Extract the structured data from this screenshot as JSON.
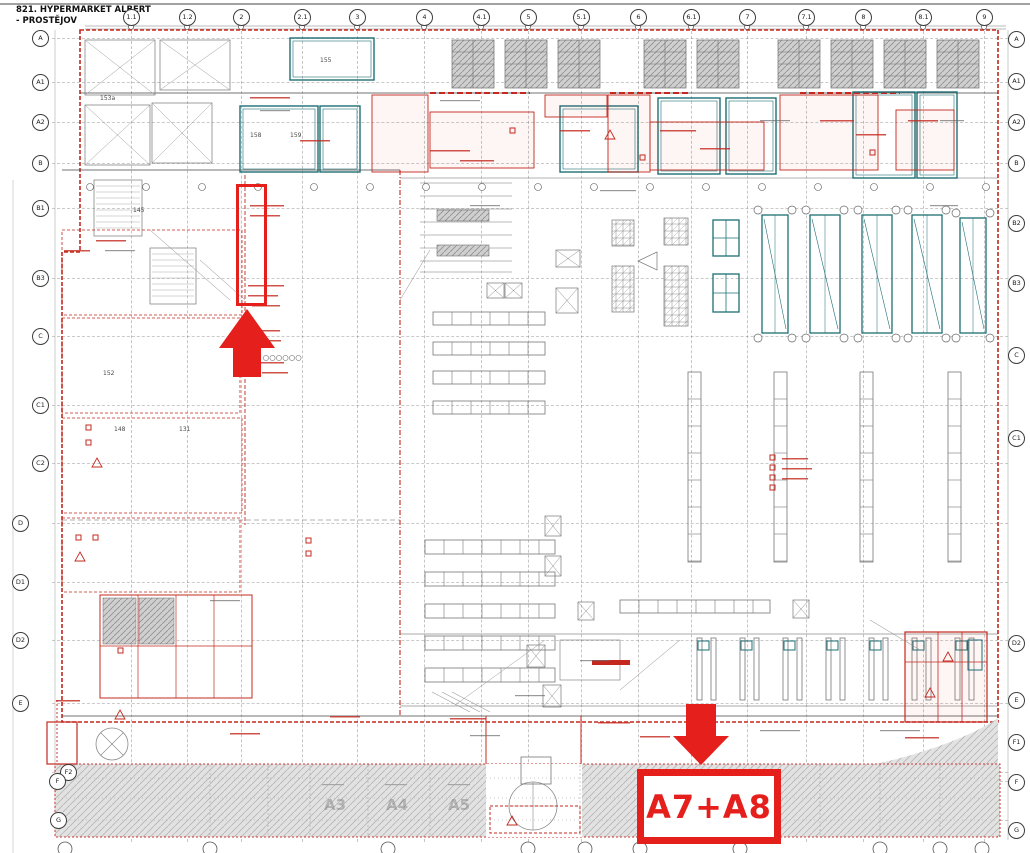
{
  "title": {
    "line1": "821. HYPERMARKET ALBERT",
    "line2": "- PROSTĚJOV"
  },
  "annotations": {
    "zone_label": "A7+A8"
  },
  "grid": {
    "top": [
      {
        "label": "1.1",
        "x": 131,
        "y": 17
      },
      {
        "label": "1.2",
        "x": 187,
        "y": 17
      },
      {
        "label": "2",
        "x": 241,
        "y": 17
      },
      {
        "label": "2.1",
        "x": 302,
        "y": 17
      },
      {
        "label": "3",
        "x": 357,
        "y": 17
      },
      {
        "label": "4",
        "x": 424,
        "y": 17
      },
      {
        "label": "4.1",
        "x": 481,
        "y": 17
      },
      {
        "label": "5",
        "x": 528,
        "y": 17
      },
      {
        "label": "5.1",
        "x": 581,
        "y": 17
      },
      {
        "label": "6",
        "x": 638,
        "y": 17
      },
      {
        "label": "6.1",
        "x": 691,
        "y": 17
      },
      {
        "label": "7",
        "x": 747,
        "y": 17
      },
      {
        "label": "7.1",
        "x": 806,
        "y": 17
      },
      {
        "label": "8",
        "x": 863,
        "y": 17
      },
      {
        "label": "8.1",
        "x": 923,
        "y": 17
      },
      {
        "label": "9",
        "x": 984,
        "y": 17
      }
    ],
    "left": [
      {
        "label": "A",
        "x": 40,
        "y": 38
      },
      {
        "label": "A1",
        "x": 40,
        "y": 82
      },
      {
        "label": "A2",
        "x": 40,
        "y": 122
      },
      {
        "label": "B",
        "x": 40,
        "y": 163
      },
      {
        "label": "B1",
        "x": 40,
        "y": 208
      },
      {
        "label": "B3",
        "x": 40,
        "y": 278
      },
      {
        "label": "C",
        "x": 40,
        "y": 336
      },
      {
        "label": "C1",
        "x": 40,
        "y": 405
      },
      {
        "label": "C2",
        "x": 40,
        "y": 463
      },
      {
        "label": "D",
        "x": 20,
        "y": 523
      },
      {
        "label": "D1",
        "x": 20,
        "y": 582
      },
      {
        "label": "D2",
        "x": 20,
        "y": 640
      },
      {
        "label": "E",
        "x": 20,
        "y": 703
      },
      {
        "label": "F2",
        "x": 68,
        "y": 772
      },
      {
        "label": "F",
        "x": 57,
        "y": 781
      },
      {
        "label": "G",
        "x": 58,
        "y": 820
      }
    ],
    "right": [
      {
        "label": "A",
        "x": 1016,
        "y": 39
      },
      {
        "label": "A1",
        "x": 1016,
        "y": 81
      },
      {
        "label": "A2",
        "x": 1016,
        "y": 122
      },
      {
        "label": "B",
        "x": 1016,
        "y": 163
      },
      {
        "label": "B2",
        "x": 1016,
        "y": 223
      },
      {
        "label": "B3",
        "x": 1016,
        "y": 283
      },
      {
        "label": "C",
        "x": 1016,
        "y": 355
      },
      {
        "label": "C1",
        "x": 1016,
        "y": 438
      },
      {
        "label": "D2",
        "x": 1016,
        "y": 643
      },
      {
        "label": "E",
        "x": 1016,
        "y": 700
      },
      {
        "label": "F1",
        "x": 1016,
        "y": 742
      },
      {
        "label": "F",
        "x": 1016,
        "y": 782
      },
      {
        "label": "G",
        "x": 1016,
        "y": 830
      }
    ]
  },
  "zones": [
    {
      "label": "A3",
      "x": 324,
      "y": 796
    },
    {
      "label": "A4",
      "x": 386,
      "y": 796
    },
    {
      "label": "A5",
      "x": 448,
      "y": 796
    }
  ],
  "rooms": [
    {
      "label": "153a",
      "x": 100,
      "y": 95
    },
    {
      "label": "155",
      "x": 320,
      "y": 57
    },
    {
      "label": "158",
      "x": 250,
      "y": 132
    },
    {
      "label": "159",
      "x": 290,
      "y": 132
    },
    {
      "label": "145",
      "x": 133,
      "y": 207
    },
    {
      "label": "152",
      "x": 103,
      "y": 370
    },
    {
      "label": "148",
      "x": 114,
      "y": 426
    },
    {
      "label": "131",
      "x": 179,
      "y": 426
    }
  ],
  "colors": {
    "annotation_red": "#e41f1c",
    "drawing_red": "#c4281e",
    "teal": "#1e6f74",
    "hatch_gray": "#e0e0e0"
  }
}
